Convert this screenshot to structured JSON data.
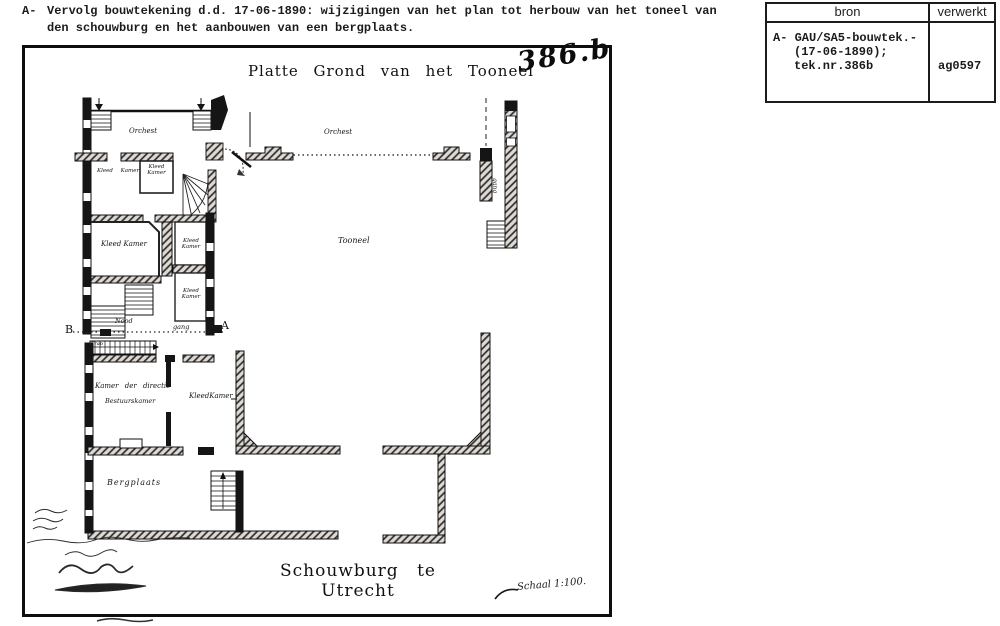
{
  "document": {
    "annotation_letter": "A-",
    "header_line1": "Vervolg bouwtekening d.d. 17-06-1890: wijzigingen van het plan tot herbouw van het toneel van",
    "header_line2": "den schouwburg en het aanbouwen van een bergplaats."
  },
  "reference_table": {
    "header_bron": "bron",
    "header_verwerkt": "verwerkt",
    "bron_line1": "A- GAU/SA5-bouwtek.-",
    "bron_line2": "(17-06-1890);",
    "bron_line3": "tek.nr.386b",
    "verwerkt_value": "ag0597"
  },
  "plan": {
    "title": "Platte Grond van het Tooneel",
    "sheet_number": "386.b",
    "caption": "Schouwburg te Utrecht",
    "scale_label": "Schaal 1:100.",
    "rooms": {
      "orchest_left": "Orchest",
      "orchest_pit": "Orchest",
      "tooneel": "Tooneel",
      "kleedkamer_1": "Kleed Kamer",
      "kleedkamer_2": "Kleed Kamer",
      "kleedkamer_3": "Kleed Kamer",
      "kleedkamer_4": "Kleed Kamer",
      "kleedkamer_5": "Kleed Kamer",
      "kleedkamer_6": "KleedKamer",
      "kamer_directie": "Kamer der directie",
      "bestuurskamer": "Bestuurskamer",
      "bergplaats": "Bergplaats",
      "trap": "Trap",
      "gang_vertical": "gang"
    },
    "corridor": {
      "marker_b": "B",
      "label_nood": "Nood",
      "label_gang": "gang",
      "marker_a": "A"
    }
  }
}
